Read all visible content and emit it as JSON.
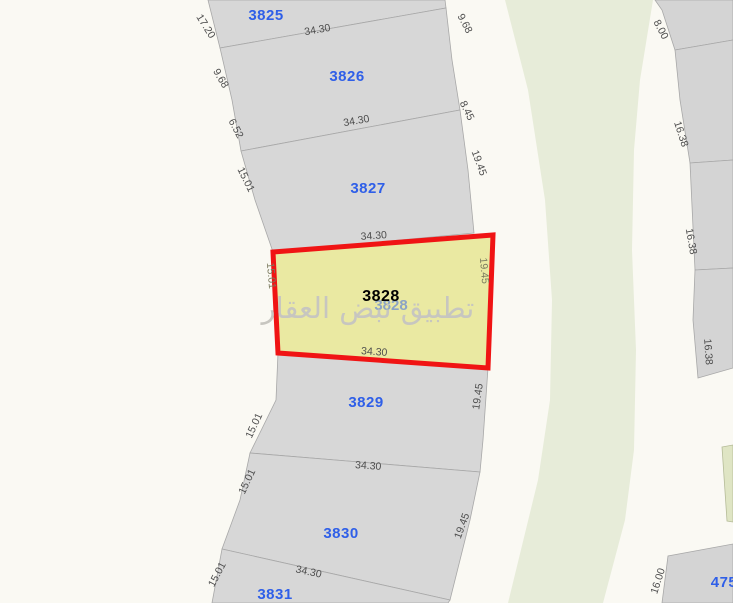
{
  "app": {
    "watermark": "تطبيق نبض العقار"
  },
  "map": {
    "colors": {
      "parcel_fill": "#d7d7d7",
      "road": "#faf9f3",
      "green_area": "#e7ecd9",
      "highlight_fill": "#eae9a2",
      "highlight_border": "#f01414",
      "parcel_number_blue": "#2f5fe8",
      "dimension_text": "#4d4d4d"
    },
    "highlighted_parcel": {
      "number": "3828",
      "x": 381,
      "y": 301,
      "ghost_x": 391,
      "ghost_y": 310
    },
    "parcels": [
      {
        "number": "3825",
        "x": 266,
        "y": 20
      },
      {
        "number": "3826",
        "x": 347,
        "y": 81
      },
      {
        "number": "3827",
        "x": 368,
        "y": 193
      },
      {
        "number": "3829",
        "x": 366,
        "y": 407
      },
      {
        "number": "3830",
        "x": 341,
        "y": 538
      },
      {
        "number": "3831",
        "x": 275,
        "y": 599
      },
      {
        "number": "475",
        "x": 724,
        "y": 587
      }
    ],
    "dim_labels": [
      {
        "text": "17.20",
        "x": 203,
        "y": 28,
        "rot": 58
      },
      {
        "text": "9.68",
        "x": 218,
        "y": 80,
        "rot": 60
      },
      {
        "text": "6.52",
        "x": 233,
        "y": 130,
        "rot": 62
      },
      {
        "text": "15.01",
        "x": 243,
        "y": 181,
        "rot": 64
      },
      {
        "text": "15.01",
        "x": 268,
        "y": 276,
        "rot": 85,
        "tone": "inner"
      },
      {
        "text": "15.01",
        "x": 257,
        "y": 427,
        "rot": -65
      },
      {
        "text": "15.01",
        "x": 250,
        "y": 483,
        "rot": -65
      },
      {
        "text": "15.01",
        "x": 220,
        "y": 576,
        "rot": -62
      },
      {
        "text": "9.68",
        "x": 462,
        "y": 25,
        "rot": 62
      },
      {
        "text": "8.45",
        "x": 464,
        "y": 112,
        "rot": 64
      },
      {
        "text": "19.45",
        "x": 476,
        "y": 164,
        "rot": 70
      },
      {
        "text": "19.45",
        "x": 481,
        "y": 271,
        "rot": 85,
        "tone": "inner"
      },
      {
        "text": "19.45",
        "x": 481,
        "y": 397,
        "rot": -82
      },
      {
        "text": "19.45",
        "x": 465,
        "y": 527,
        "rot": -70
      },
      {
        "text": "8.00",
        "x": 658,
        "y": 31,
        "rot": 62
      },
      {
        "text": "16.38",
        "x": 678,
        "y": 135,
        "rot": 72
      },
      {
        "text": "16.38",
        "x": 688,
        "y": 242,
        "rot": 80
      },
      {
        "text": "16.38",
        "x": 705,
        "y": 352,
        "rot": 86
      },
      {
        "text": "16.00",
        "x": 661,
        "y": 582,
        "rot": -72
      },
      {
        "text": "34.30",
        "x": 318,
        "y": 33,
        "rot": -10
      },
      {
        "text": "34.30",
        "x": 357,
        "y": 124,
        "rot": -10
      },
      {
        "text": "34.30",
        "x": 374,
        "y": 239,
        "rot": -4
      },
      {
        "text": "34.30",
        "x": 374,
        "y": 355,
        "rot": 4
      },
      {
        "text": "34.30",
        "x": 368,
        "y": 469,
        "rot": 4
      },
      {
        "text": "34.30",
        "x": 308,
        "y": 575,
        "rot": 12
      }
    ]
  }
}
